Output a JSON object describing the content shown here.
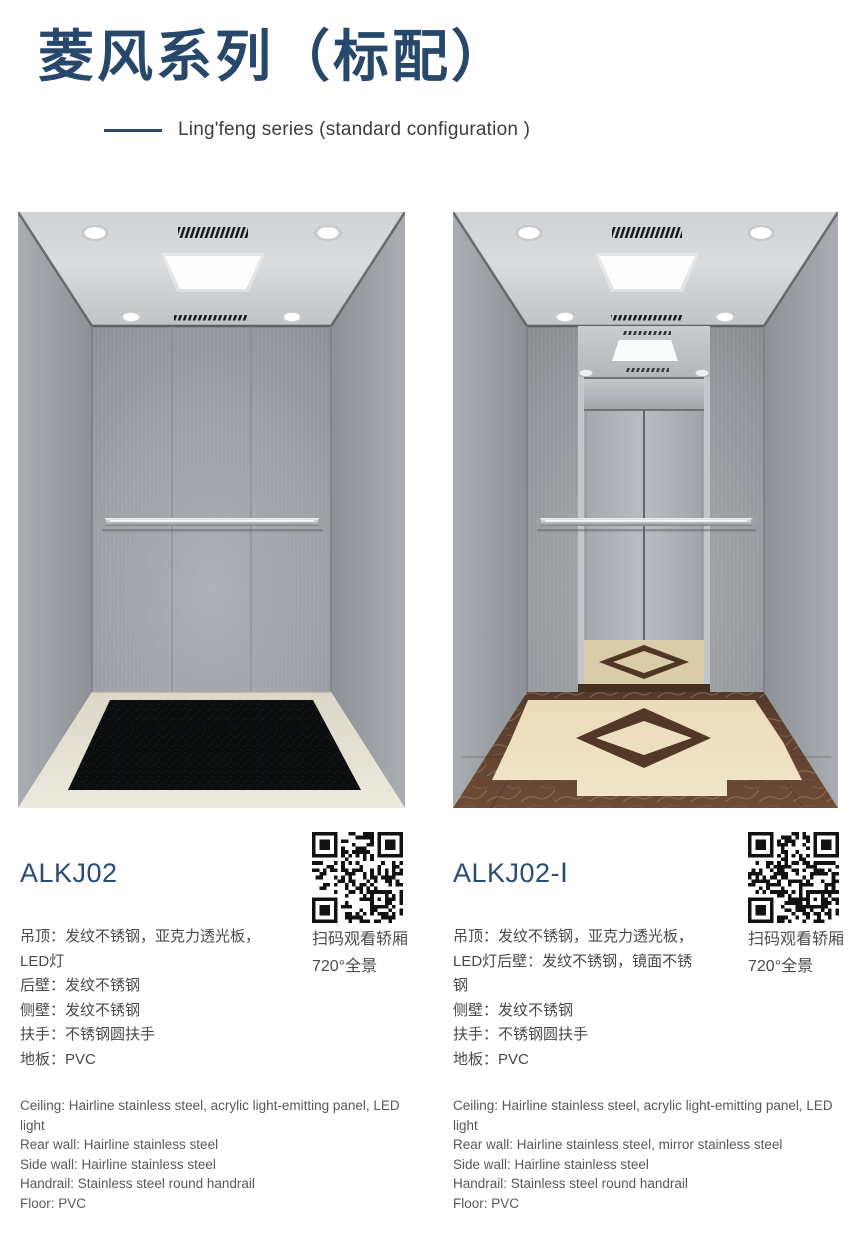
{
  "header": {
    "title_cn": "菱风系列（标配）",
    "subtitle_en": "Ling'feng series (standard configuration )"
  },
  "colors": {
    "accent_navy": "#2c4a63",
    "model_blue": "#2a4c78",
    "body_text": "#494949",
    "secondary_text": "#57585a",
    "floor_mat_black": "#0c0d0e",
    "marble_brown": "#6d4b37",
    "floor_cream": "#ecdfbe"
  },
  "products": [
    {
      "model": "ALKJ02",
      "specs_cn": [
        "吊顶：发纹不锈钢，亚克力透光板，LED灯",
        "后壁：发纹不锈钢",
        "侧壁：发纹不锈钢",
        "扶手：不锈钢圆扶手",
        "地板：PVC"
      ],
      "specs_en": [
        "Ceiling: Hairline stainless steel, acrylic light-emitting panel, LED light",
        "Rear wall: Hairline stainless steel",
        "Side wall: Hairline stainless steel",
        "Handrail: Stainless steel round handrail",
        "Floor: PVC"
      ],
      "qr_caption": [
        "扫码观看轿厢",
        "720°全景"
      ]
    },
    {
      "model": "ALKJ02-Ⅰ",
      "specs_cn": [
        "吊顶：发纹不锈钢，亚克力透光板，LED灯后壁：发纹不锈钢，镜面不锈钢",
        "侧壁：发纹不锈钢",
        "扶手：不锈钢圆扶手",
        "地板：PVC"
      ],
      "specs_en": [
        "Ceiling: Hairline stainless steel, acrylic light-emitting panel, LED light",
        "Rear wall: Hairline stainless steel, mirror stainless steel",
        "Side wall: Hairline stainless steel",
        "Handrail: Stainless steel round handrail",
        "Floor: PVC"
      ],
      "qr_caption": [
        "扫码观看轿厢",
        "720°全景"
      ]
    }
  ]
}
